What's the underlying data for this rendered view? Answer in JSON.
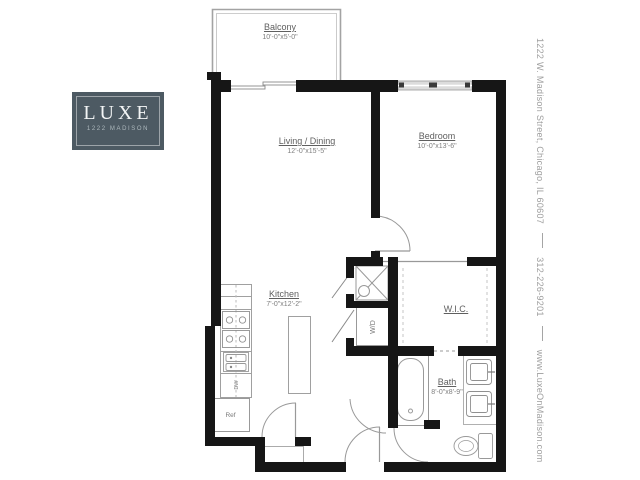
{
  "logo": {
    "name": "LUXE",
    "subtitle": "1222 MADISON"
  },
  "contact": {
    "address": "1222 W. Madison Street, Chicago, IL 60607",
    "phone": "312-226-9201",
    "website": "www.LuxeOnMadison.com"
  },
  "rooms": {
    "balcony": {
      "label": "Balcony",
      "dims": "10'-0\"x5'-0\""
    },
    "living": {
      "label": "Living / Dining",
      "dims": "12'-0\"x15'-5\""
    },
    "bedroom": {
      "label": "Bedroom",
      "dims": "10'-0\"x13'-6\""
    },
    "kitchen": {
      "label": "Kitchen",
      "dims": "7'-0\"x12'-2\""
    },
    "wic": {
      "label": "W.I.C."
    },
    "bath": {
      "label": "Bath",
      "dims": "8'-0\"x8'-9\""
    }
  },
  "fixtures": {
    "washer_dryer": "W/D",
    "refrigerator": "Ref",
    "dishwasher": "DW"
  },
  "colors": {
    "wall": "#161616",
    "line": "#999999",
    "logo_bg": "#4d5a63"
  }
}
